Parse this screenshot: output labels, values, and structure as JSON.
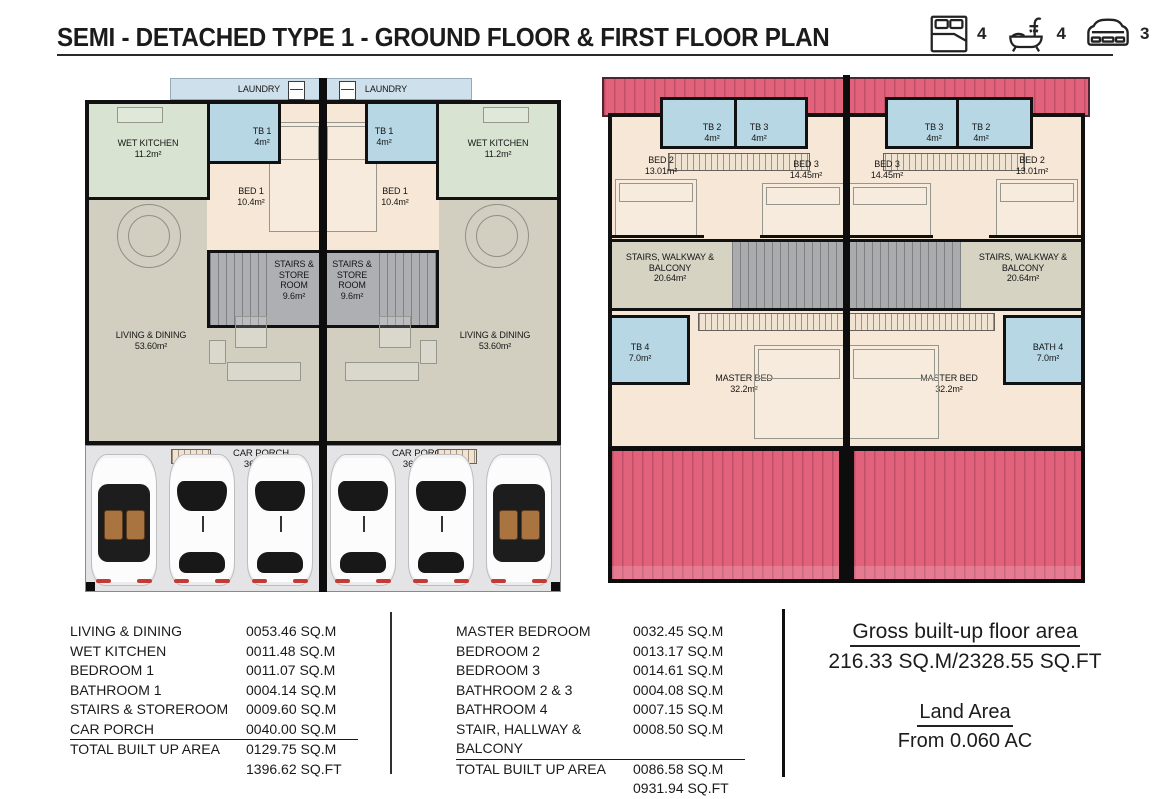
{
  "header": {
    "title": "SEMI - DETACHED TYPE 1 - GROUND FLOOR & FIRST FLOOR PLAN",
    "legend": {
      "bedrooms": "4",
      "bathrooms": "4",
      "carparks": "3"
    }
  },
  "ground_floor": {
    "laundry_label": "LAUNDRY",
    "wet_kitchen": {
      "name": "WET KITCHEN",
      "area": "11.2m²"
    },
    "tb1": {
      "name": "TB 1",
      "area": "4m²"
    },
    "bed1": {
      "name": "BED 1",
      "area": "10.4m²"
    },
    "stairs_store": {
      "name": "STAIRS & STORE ROOM",
      "area": "9.6m²"
    },
    "living_dining": {
      "name": "LIVING & DINING",
      "area": "53.60m²"
    },
    "car_porch": {
      "name": "CAR PORCH",
      "area": "36.00m²"
    }
  },
  "first_floor": {
    "bed2": {
      "name": "BED 2",
      "area": "13.01m²"
    },
    "bed3": {
      "name": "BED 3",
      "area": "14.45m²"
    },
    "tb2": {
      "name": "TB 2",
      "area": "4m²"
    },
    "tb3": {
      "name": "TB 3",
      "area": "4m²"
    },
    "stairs_walkway": {
      "name": "STAIRS, WALKWAY & BALCONY",
      "area": "20.64m²"
    },
    "tb4": {
      "name": "TB 4",
      "area": "7.0m²"
    },
    "bath4": {
      "name": "BATH 4",
      "area": "7.0m²"
    },
    "master_bed": {
      "name": "MASTER BED",
      "area": "32.2m²"
    }
  },
  "ground_table": {
    "rows": [
      {
        "label": "LIVING & DINING",
        "value": "0053.46 SQ.M"
      },
      {
        "label": "WET KITCHEN",
        "value": "0011.48 SQ.M"
      },
      {
        "label": "BEDROOM 1",
        "value": "0011.07 SQ.M"
      },
      {
        "label": "BATHROOM 1",
        "value": "0004.14 SQ.M"
      },
      {
        "label": "STAIRS & STOREROOM",
        "value": "0009.60 SQ.M"
      },
      {
        "label": "CAR PORCH",
        "value": "0040.00 SQ.M"
      },
      {
        "label": "TOTAL BUILT UP AREA",
        "value": "0129.75 SQ.M"
      },
      {
        "label": "",
        "value": "1396.62 SQ.FT"
      }
    ]
  },
  "first_table": {
    "rows": [
      {
        "label": "MASTER BEDROOM",
        "value": "0032.45 SQ.M"
      },
      {
        "label": "BEDROOM 2",
        "value": "0013.17 SQ.M"
      },
      {
        "label": "BEDROOM 3",
        "value": "0014.61 SQ.M"
      },
      {
        "label": "BATHROOM 2 & 3",
        "value": "0004.08 SQ.M"
      },
      {
        "label": "BATHROOM 4",
        "value": "0007.15 SQ.M"
      },
      {
        "label": "STAIR, HALLWAY & BALCONY",
        "value": "0008.50 SQ.M"
      },
      {
        "label": "TOTAL BUILT UP AREA",
        "value": "0086.58 SQ.M"
      },
      {
        "label": "",
        "value": "0931.94 SQ.FT"
      }
    ]
  },
  "summary": {
    "gross_title": "Gross built-up floor area",
    "gross_value": "216.33 SQ.M/2328.55 SQ.FT",
    "land_title": "Land Area",
    "land_value": "From 0.060 AC"
  }
}
